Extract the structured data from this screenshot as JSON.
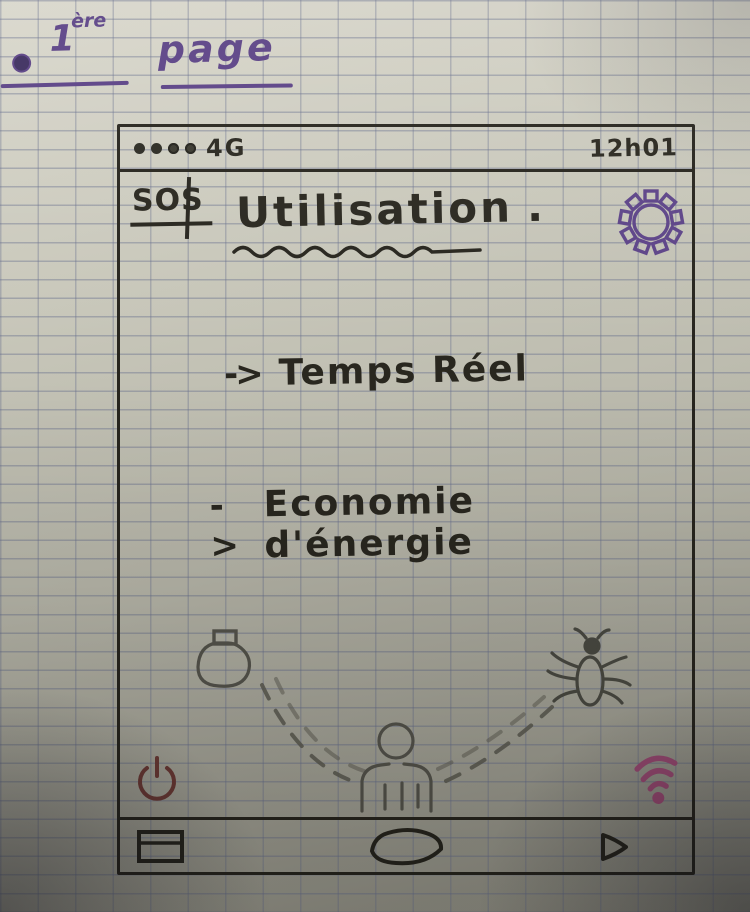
{
  "page_annotation": {
    "label_number": "1",
    "label_suffix": "ère",
    "label_word": "page"
  },
  "phone": {
    "status_bar": {
      "signal_dots_count": 4,
      "network": "4G",
      "time": "12h01"
    },
    "header": {
      "sos_label": "SOS",
      "title": "Utilisation",
      "title_punctuation": "."
    },
    "menu": {
      "items": [
        {
          "arrow": "->",
          "label": "Temps Réel"
        },
        {
          "arrow": "->",
          "label": "Economie d'énergie"
        }
      ]
    },
    "illustration": {
      "icons": [
        "diffuser-icon",
        "dashed-arc-left",
        "person-icon",
        "dashed-arc-right",
        "mosquito-icon"
      ]
    },
    "side_icons": {
      "power": "power-icon",
      "wifi": "wifi-icon"
    },
    "nav_bar": {
      "icons": [
        "recents-icon",
        "home-icon",
        "back-icon"
      ]
    }
  },
  "colors": {
    "ink_purple": "#5d4488",
    "pen_black": "#29271f",
    "pencil_gray": "#55544c",
    "power_maroon": "#6e3b36",
    "wifi_pink": "#a34e79",
    "paper": "#bdbcb0",
    "grid_line": "#666e8c"
  }
}
